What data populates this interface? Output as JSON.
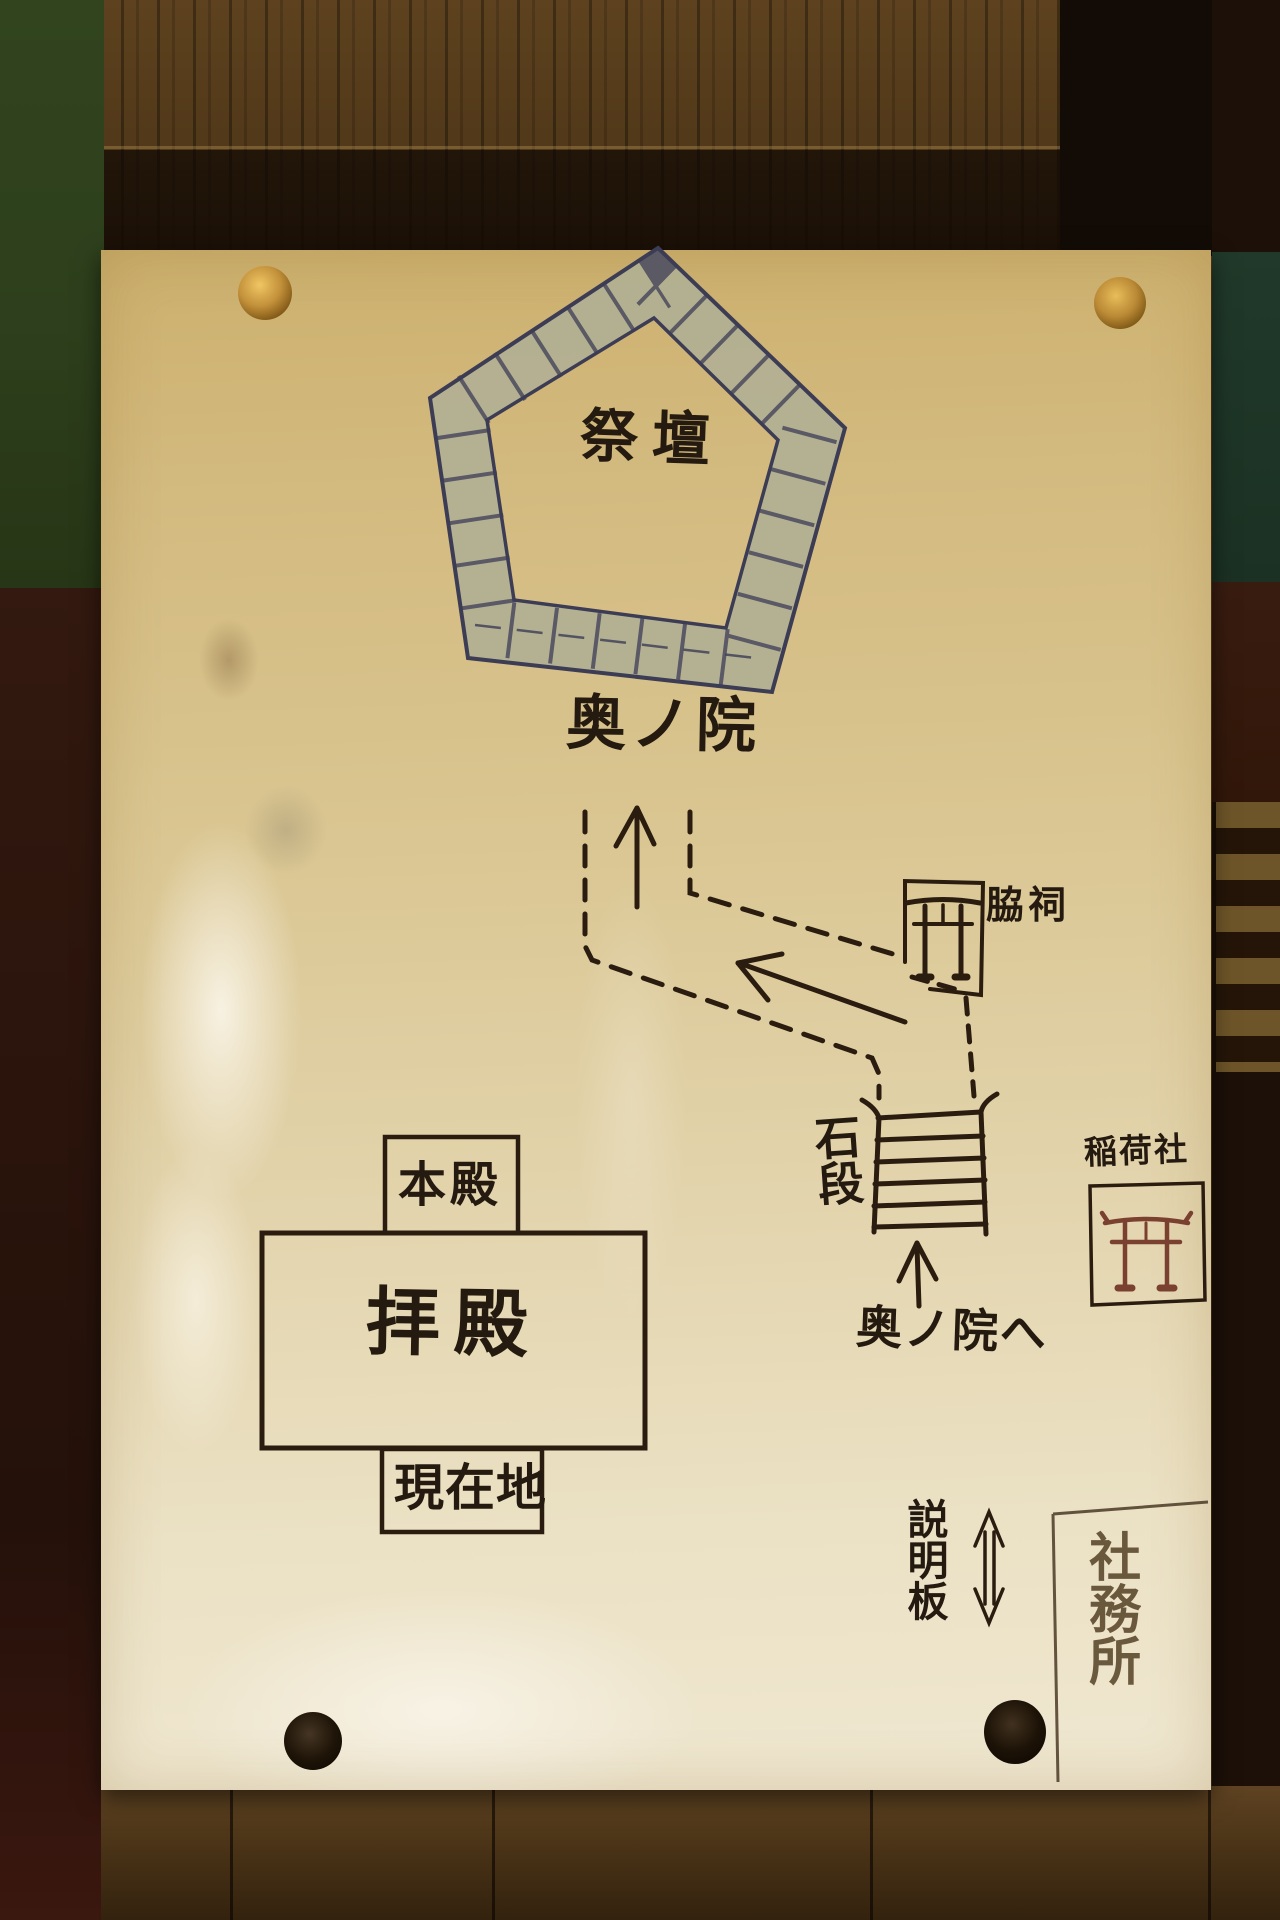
{
  "paper": {
    "labels": {
      "saidan": "祭壇",
      "okunoin": "奥ノ院",
      "wakihokora": "脇祠",
      "ishidan": "石段",
      "okunoin_e": "奥ノ院へ",
      "inarisha": "稲荷社",
      "honden": "本殿",
      "haiden": "拝殿",
      "genzaichi": "現在地",
      "setsumeiban": "説明板",
      "shamusho": "社務所"
    },
    "colors": {
      "ink": "#2b1c10",
      "stone_fill": "#b1b094",
      "stone_outline": "#3c3c55",
      "red_torii": "#7a4030",
      "paper_cream": "#dcc792",
      "pin_gold": "#c2903a",
      "pin_black": "#1d1307"
    },
    "icons": {
      "altar_wall": "stone-pentagon-wall",
      "side_shrine": "torii-icon",
      "inari_shrine": "red-torii-icon",
      "stairs": "stone-steps-icon",
      "route_up": "up-arrow-icon",
      "route_diagonal": "up-left-arrow-icon",
      "to_okunoin": "up-arrow-icon",
      "signboard_marker": "double-headed-arrow-icon"
    }
  }
}
